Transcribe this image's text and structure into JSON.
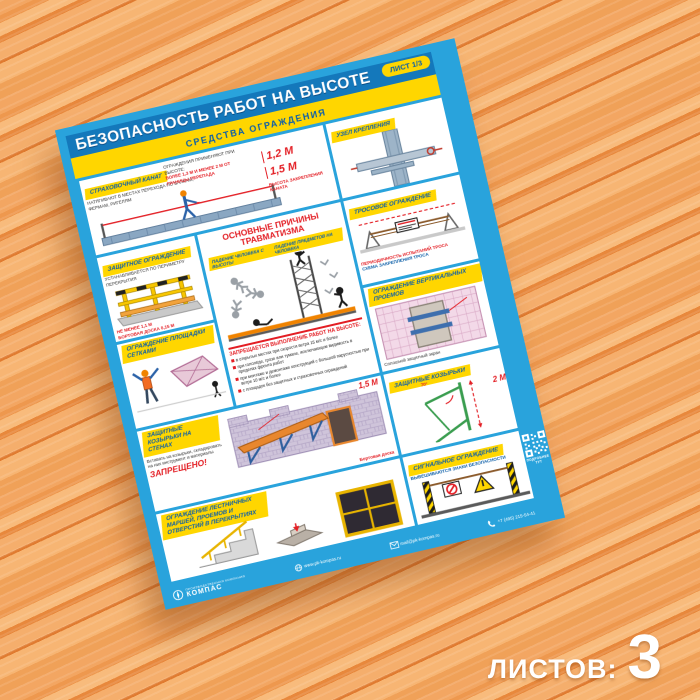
{
  "colors": {
    "border_cyan": "#29A3DC",
    "header_blue": "#1478BB",
    "accent_yellow": "#FFD600",
    "accent_red": "#E31E24",
    "wood_base": "#F2A261"
  },
  "overlay": {
    "sheets_label": "ЛИСТОВ:",
    "sheets_count": "3"
  },
  "poster": {
    "badge": "ЛИСТ 1/3",
    "title": "БЕЗОПАСНОСТЬ РАБОТ НА ВЫСОТЕ",
    "subtitle": "СРЕДСТВА ОГРАЖДЕНИЯ",
    "panels": {
      "rope": {
        "label": "СТРАХОВОЧНЫЙ КАНАТ",
        "note": "НАТЯГИВАЮТ В МЕСТАХ ПЕРЕХОДА ПО БАЛКАМ, ФЕРМАМ, РИГЕЛЯМ",
        "rule": "ОГРАЖДЕНИЯ ПРИМЕНЯЮТ ПРИ ВЫСОТЕ:",
        "rule_red": "БОЛЕЕ 1,3 М И МЕНЕЕ 2 М ОТ ГРАНИЦЫ ПЕРЕПАДА",
        "dim1": "1,2 М",
        "dim2": "1,5 М",
        "dims_note": "ВЫСОТА ЗАКРЕПЛЕНИЯ КАНАТА"
      },
      "node": {
        "label": "УЗЕЛ КРЕПЛЕНИЯ"
      },
      "guard": {
        "label": "ЗАЩИТНОЕ ОГРАЖДЕНИЕ",
        "note": "УСТАНАВЛИВАЕТСЯ ПО ПЕРИМЕТРУ ПЕРЕКРЫТИЯ",
        "dim1": "НЕ МЕНЕЕ 1,1 М",
        "dim2": "БОРТОВАЯ ДОСКА 0,15 М"
      },
      "causes": {
        "title1": "ОСНОВНЫЕ ПРИЧИНЫ",
        "title2": "ТРАВМАТИЗМА",
        "chip1": "ПАДЕНИЕ ЧЕЛОВЕКА С ВЫСОТЫ",
        "chip2": "ПАДЕНИЕ ПРЕДМЕТОВ НА ЧЕЛОВЕКА",
        "ban_title": "ЗАПРЕЩАЕТСЯ ВЫПОЛНЕНИЕ РАБОТ НА ВЫСОТЕ:",
        "bullets": [
          "в открытых местах при скорости ветра 15 м/с и более",
          "при гололёде, грозе или тумане, исключающем видимость в пределах фронта работ",
          "при монтаже и демонтаже конструкций с большой парусностью при ветре 10 м/с и более",
          "с площадок без защитных и страховочных ограждений"
        ]
      },
      "cable": {
        "label": "ТРОСОВОЕ ОГРАЖДЕНИЕ",
        "note1": "ПЕРИОДИЧНОСТЬ ИСПЫТАНИЙ ТРОСА",
        "note2": "СХЕМА ЗАКРЕПЛЕНИЯ ТРОСА"
      },
      "openings": {
        "label": "ОГРАЖДЕНИЕ ВЕРТИКАЛЬНЫХ ПРОЕМОВ",
        "note": "Сплошной защитный экран"
      },
      "net": {
        "label": "ОГРАЖДЕНИЕ ПЛОЩАДКИ СЕТКАМИ"
      },
      "visor": {
        "label": "ЗАЩИТНЫЕ КОЗЫРЬКИ",
        "dim": "2 М",
        "angle": "70°"
      },
      "wall_visor": {
        "label": "ЗАЩИТНЫЕ КОЗЫРЬКИ НА СТЕНАХ",
        "warn": "Вставать на козырьки, складировать на них инструмент и материалы",
        "forbidden": "ЗАПРЕЩЕНО!",
        "dim": "1,5 М",
        "board": "Бортовая доска"
      },
      "signal": {
        "label": "СИГНАЛЬНОЕ ОГРАЖДЕНИЕ",
        "note": "ВЫВЕШИВАЮТСЯ ЗНАКИ БЕЗОПАСНОСТИ"
      },
      "stairs": {
        "label": "ОГРАЖДЕНИЕ ЛЕСТНИЧНЫХ МАРШЕЙ, ПРОЕМОВ И ОТВЕРСТИЙ В ПЕРЕКРЫТИЯХ"
      }
    },
    "side": {
      "qr_label": "ПОДРОБНЕЕ ТУТ"
    },
    "footer": {
      "brand": "КОМПАС",
      "brand_tagline": "ПРОИЗВОДСТВЕННАЯ КОМПАНИЯ",
      "website": "www.pk-kompas.ru",
      "email": "mail@pk-kompas.ru",
      "phone": "+7 (495) 215-54-41"
    }
  }
}
